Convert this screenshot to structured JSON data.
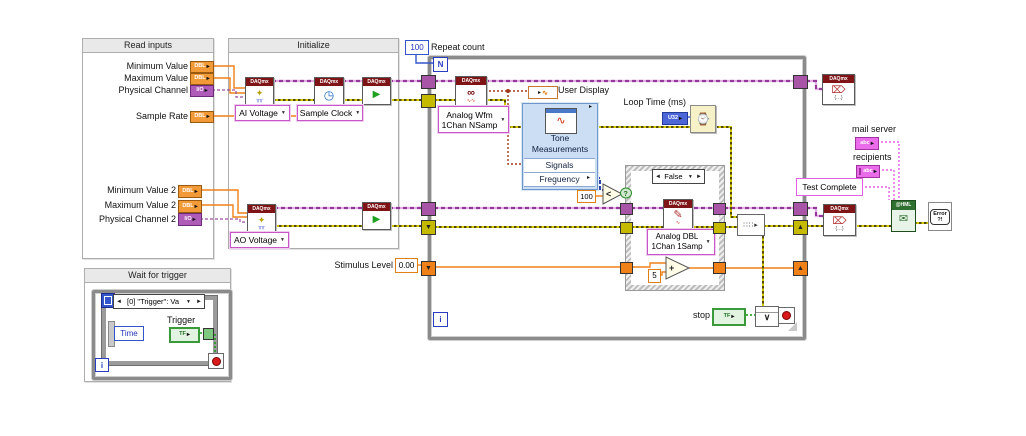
{
  "daqmx_header": "DAQmx",
  "frames": {
    "read_inputs": {
      "title": "Read inputs",
      "rows": [
        {
          "label": "Minimum Value",
          "type": "DBL"
        },
        {
          "label": "Maximum Value",
          "type": "DBL"
        },
        {
          "label": "Physical Channel",
          "type": "I/O"
        },
        {
          "label": "Sample Rate",
          "type": "DBL"
        },
        {
          "label": "Minimum Value 2",
          "type": "DBL"
        },
        {
          "label": "Maximum Value 2",
          "type": "DBL"
        },
        {
          "label": "Physical Channel 2",
          "type": "I/O"
        }
      ]
    },
    "initialize": {
      "title": "Initialize",
      "ai_selector": "AI Voltage",
      "timing_selector": "Sample Clock",
      "ao_selector": "AO Voltage"
    },
    "wait_for_trigger": {
      "title": "Wait for trigger",
      "event_case": "[0] \"Trigger\": Va",
      "time_terminal": "Time",
      "trigger": {
        "label": "Trigger",
        "type": "TF"
      },
      "iteration": "i"
    }
  },
  "main_loop": {
    "count_terminal": "N",
    "iteration": "i",
    "repeat_count": {
      "value": "100",
      "label": "Repeat count"
    },
    "read_selector": {
      "line1": "Analog Wfm",
      "line2": "1Chan NSamp"
    },
    "user_display": {
      "label": "User Display"
    },
    "tone": {
      "line1": "Tone",
      "line2": "Measurements",
      "input": "Signals",
      "output": "Frequency"
    },
    "loop_time": {
      "label": "Loop Time (ms)",
      "type": "U32"
    },
    "threshold": "100",
    "case_structure": {
      "selector": "False",
      "write_selector": {
        "line1": "Analog DBL",
        "line2": "1Chan 1Samp"
      },
      "increment": "5"
    },
    "stimulus": {
      "label": "Stimulus Level",
      "value": "0.00"
    },
    "stop": {
      "label": "stop",
      "type": "TF"
    }
  },
  "output_section": {
    "mail_server": {
      "label": "mail server",
      "type": "abc"
    },
    "recipients": {
      "label": "recipients",
      "type": "abc"
    },
    "test_complete": "Test Complete",
    "email_node": {
      "line1": "@HML"
    },
    "error_node": {
      "line1": "Error",
      "line2": "?!"
    }
  },
  "icons": {
    "create": "✦",
    "create_sub": "╥╥",
    "timing": "◷",
    "start": "▶",
    "read": "∞",
    "read_sub": "∿∿",
    "write": "✎",
    "write_sub": "∿",
    "clear": "⌦",
    "clear_sub": "{…}",
    "wait": "⌚",
    "or": "∨",
    "add": "+",
    "less": "<",
    "mail": "✉",
    "merge": "∷∷▸",
    "chevron_down": "⌄",
    "arrow_right": "▸",
    "arrow_left": "◄",
    "arrow_rt": "►",
    "dropdown": "▼",
    "sr_up": "▲",
    "sr_down": "▼",
    "question": "?",
    "wave": "∿"
  }
}
